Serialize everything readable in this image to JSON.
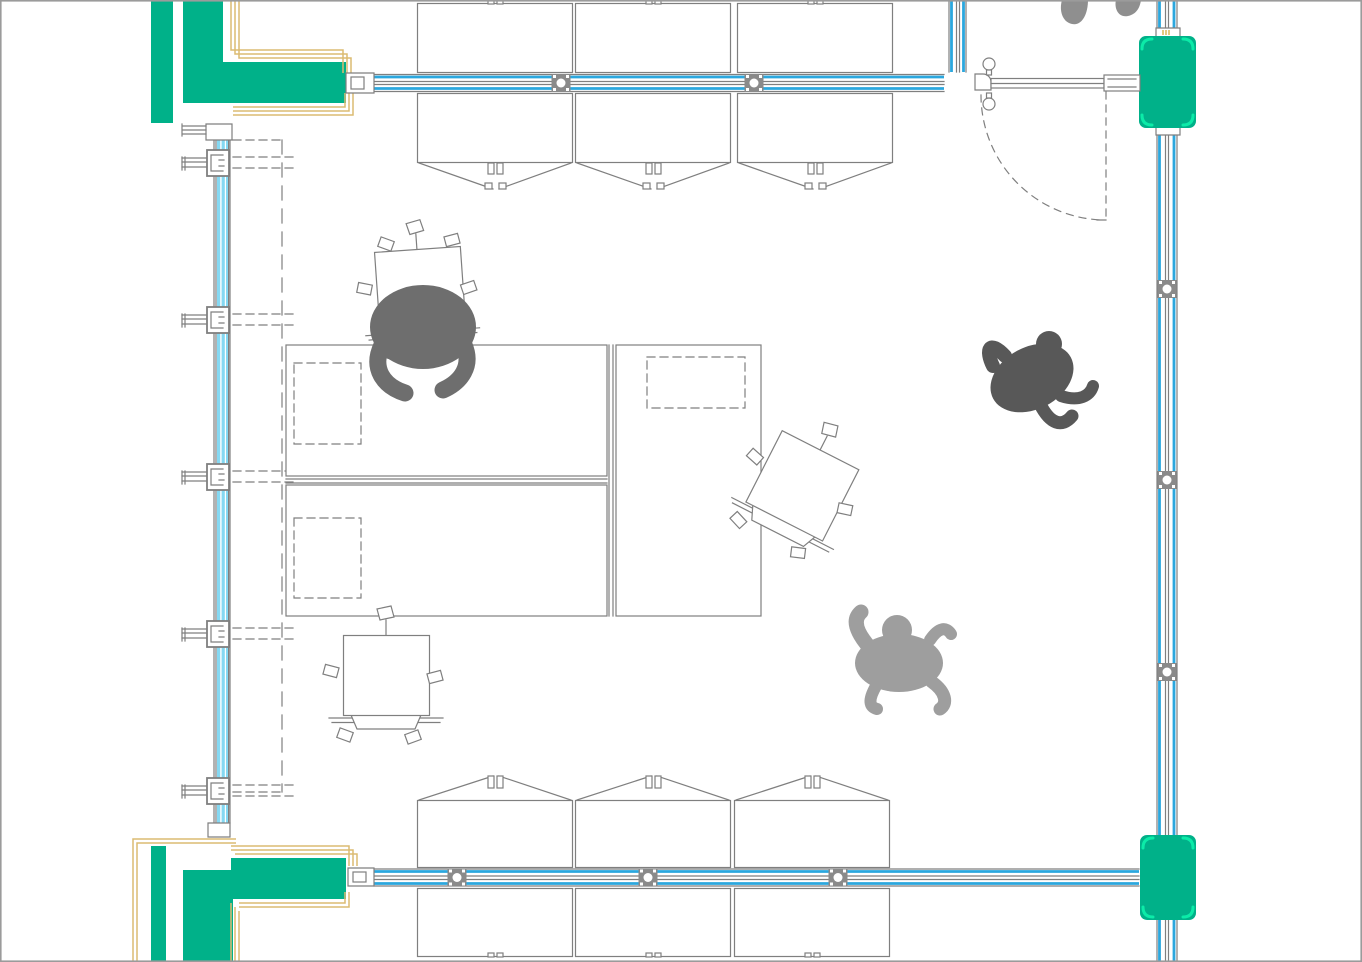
{
  "scene": {
    "type": "cad-floor-plan-viewport",
    "description": "Top-down architectural plan of a room enclosed by blue curtain walls with green structural columns at the corners, rows of desks along the north and south glazed walls, three large work tables in the centre, three square folding tables, one swing door at the north-east, and four human figures"
  },
  "colors": {
    "canvas_bg": "#ffffff",
    "line_gray": "#7f7f7f",
    "wall_blue": "#2ba7de",
    "glazing_cyan": "#85d8f2",
    "column_green": "#00b189",
    "corner_bracket_green": "#0cebA8",
    "frame_tan": "#dcbb72",
    "accent_yellow": "#d9b44a",
    "person_dark": "#6e6e6e",
    "person_darker": "#585858",
    "person_light": "#9e9e9e",
    "person_medium": "#8f8f8f",
    "viewport_border": "#9b9b9b"
  },
  "counts": {
    "people": 4,
    "wall_desks": 12,
    "center_tables": 3,
    "square_folding_tables": 3,
    "doors": 1,
    "green_columns": 4,
    "corner_wall_assemblies": 2
  },
  "layout_data": {
    "desk_rows": [
      {
        "template": "desk-out-top",
        "y": 0,
        "xs": [
          417,
          575,
          737
        ]
      },
      {
        "template": "desk-in-top",
        "y": 93,
        "xs": [
          417,
          575,
          737
        ]
      },
      {
        "template": "desk-in-bottom",
        "y": 800,
        "xs": [
          417,
          575,
          734
        ]
      },
      {
        "template": "desk-out-bottom",
        "y": 888,
        "xs": [
          417,
          575,
          734
        ]
      }
    ],
    "mullions": {
      "top_wall_x": [
        561,
        754
      ],
      "bottom_wall_x": [
        457,
        648,
        838
      ],
      "right_wall_y": [
        289,
        480,
        672
      ]
    },
    "left_wall_brackets_y": [
      163,
      320,
      477,
      634,
      791
    ],
    "square_tables": [
      {
        "x": 374,
        "y": 252,
        "rotation": -4,
        "occupied": true
      },
      {
        "x": 343,
        "y": 635,
        "rotation": 0,
        "occupied": false
      },
      {
        "x": 782,
        "y": 430,
        "rotation": 27,
        "occupied": false
      }
    ],
    "columns": [
      {
        "x": 1139,
        "y": 36,
        "w": 57,
        "h": 92
      },
      {
        "x": 1140,
        "y": 835,
        "w": 56,
        "h": 85
      }
    ]
  }
}
